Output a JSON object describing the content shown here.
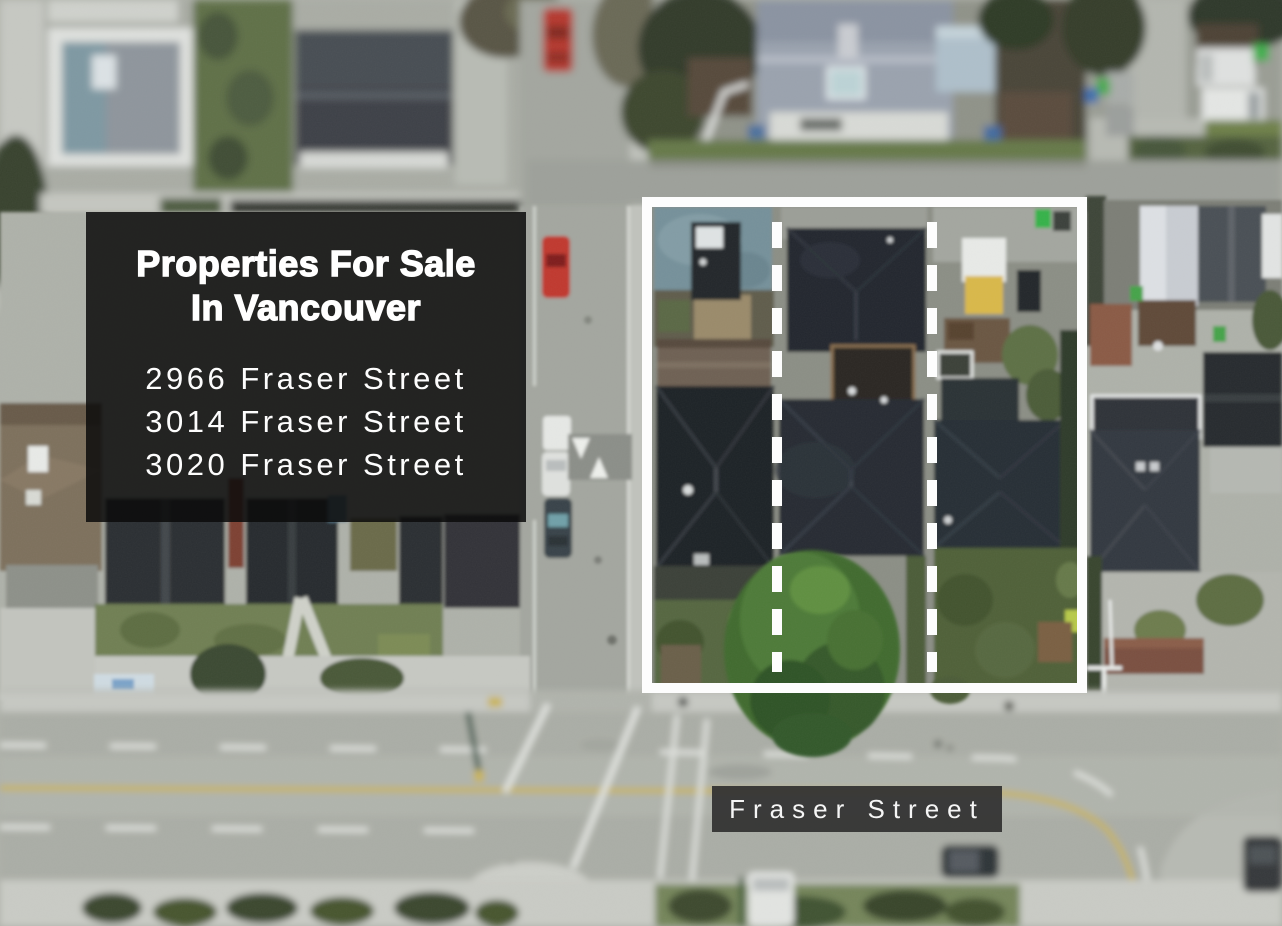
{
  "overlay": {
    "title_line1": "Properties For Sale",
    "title_line2": "In Vancouver",
    "addresses": [
      "2966 Fraser Street",
      "3014 Fraser Street",
      "3020 Fraser Street"
    ],
    "background_color": "#0a0a0a",
    "text_color": "#ffffff"
  },
  "street_label": {
    "text": "Fraser Street",
    "background_color": "#303030",
    "text_color": "#f5f5f5"
  },
  "property_outline": {
    "color": "#ffffff",
    "lot_count": 3,
    "style": "solid rectangle with two dashed lot-divider lines"
  }
}
